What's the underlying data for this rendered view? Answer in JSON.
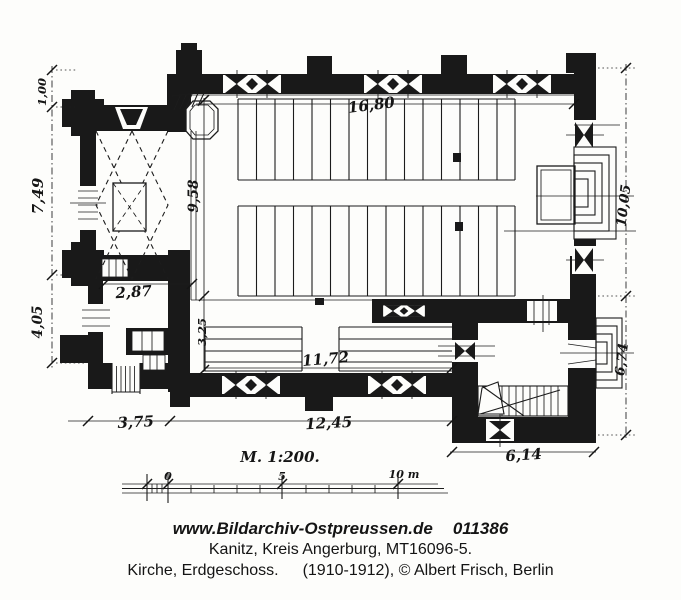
{
  "plan": {
    "dims": {
      "top_width": "16,80",
      "left_upper": "1,00",
      "left_middle": "7,49",
      "left_lower": "4,05",
      "tower_width": "2,87",
      "nave_interior_depth": "9,58",
      "aisle_depth": "3,25",
      "right_upper": "10,05",
      "right_lower": "6,74",
      "south_interior_width": "11,72",
      "porch_width": "3,75",
      "south_width": "12,45",
      "annex_width": "6,14"
    },
    "scale_bar": {
      "label": "M. 1:200.",
      "zero": "0",
      "five": "5",
      "ten": "10 m"
    }
  },
  "caption": {
    "website": "www.Bildarchiv-Ostpreussen.de",
    "archive_number": "011386",
    "location_line": "Kanitz, Kreis Angerburg, MT16096-5.",
    "subject": "Kirche, Erdgeschoss.",
    "date_credit": "(1910-1912), © Albert Frisch, Berlin"
  }
}
